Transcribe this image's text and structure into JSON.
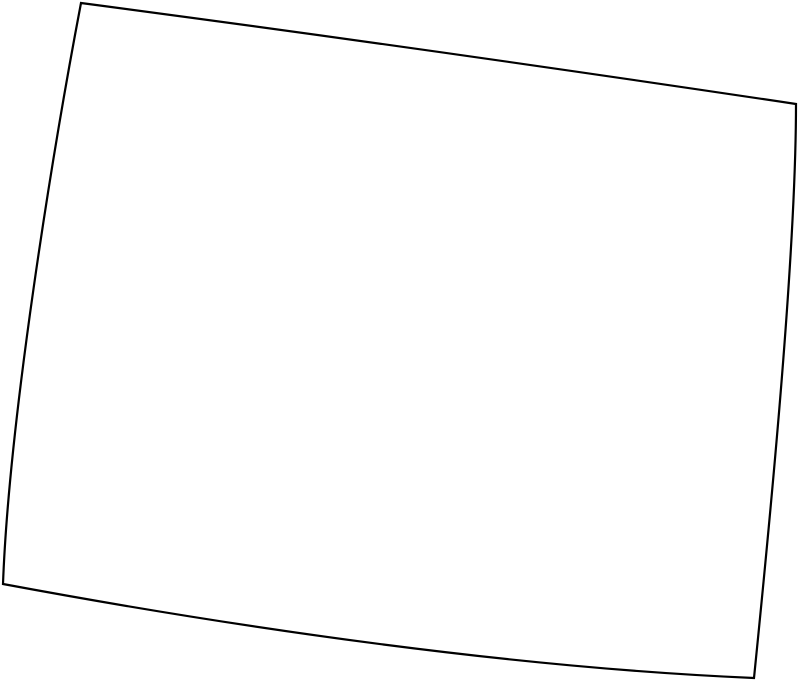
{
  "map": {
    "shape_name": "Wyoming state outline",
    "stroke_color": "#000000",
    "fill_color": "#ffffff",
    "background_color": "#ffffff",
    "stroke_width_px": 2.2,
    "outline_path": "M 81 3 Q 422 48 796 104 C 796 250 772 500 754 678 C 520 668 250 630 3 584 C 9 420 53 150 81 3 Z",
    "corners": {
      "top_left": [
        81,
        3
      ],
      "top_right": [
        796,
        104
      ],
      "bottom_right": [
        754,
        678
      ],
      "bottom_left": [
        3,
        584
      ]
    }
  }
}
